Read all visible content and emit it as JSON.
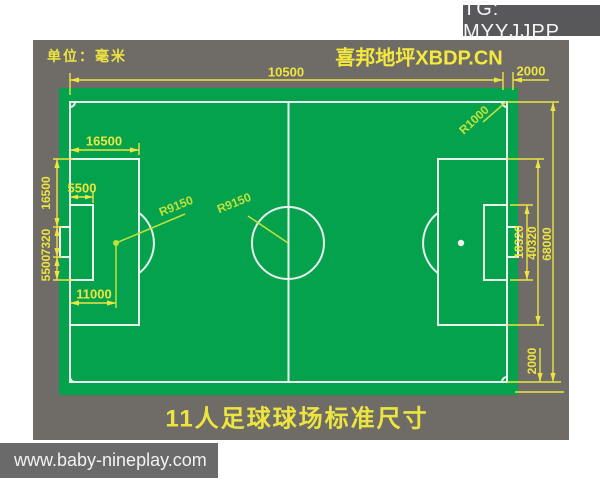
{
  "overlay": {
    "tg_badge": "TG: MYYJJPP",
    "watermark": "www.baby-nineplay.com"
  },
  "header": {
    "unit_label": "单位：毫米",
    "brand": "喜邦地坪XBDP.CN"
  },
  "caption": "11人足球球场标准尺寸",
  "dims": {
    "field_length": "10500",
    "margin_top_right": "2000",
    "penalty_area_depth": "16500",
    "goal_area_depth": "5500",
    "penalty_spot_distance": "11000",
    "penalty_flank_segment": "16500",
    "goal_width": "7320",
    "goal_area_flank_segment": "5500",
    "goal_area_width": "18320",
    "penalty_area_width": "40320",
    "field_width": "68000",
    "margin_bottom_right": "2000",
    "corner_arc_radius": "R1000",
    "penalty_arc_radius": "R9150",
    "center_circle_radius": "R9150"
  },
  "colors": {
    "panel_gray": "#6f6b67",
    "field_green": "#05a24e",
    "line_white": "#e9f3ec",
    "dim_yellow": "#ece540",
    "radius_label": "#bfe23a",
    "badge_gray": "#58585b",
    "watermark_gray": "#6a6a6a",
    "badge_text": "#f5f5f5"
  }
}
